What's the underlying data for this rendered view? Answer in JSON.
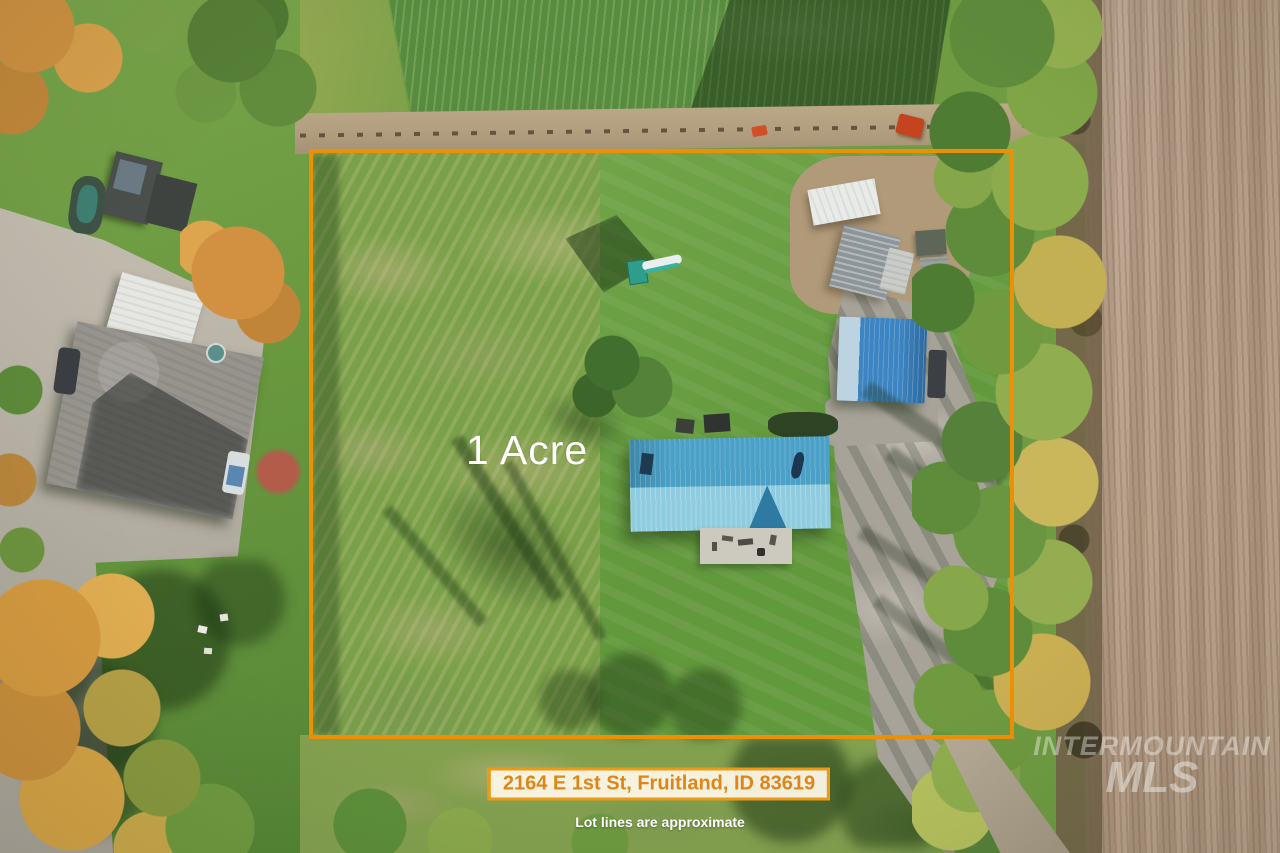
{
  "overlays": {
    "lot_label": "1 Acre",
    "address": "2164 E 1st St, Fruitland, ID 83619",
    "disclaimer": "Lot lines are approximate",
    "watermark_line1": "INTERMOUNTAIN",
    "watermark_line2": "MLS"
  },
  "colors": {
    "boundary_orange": "#EE9005",
    "banner_border": "#EC9A15",
    "banner_text": "#DE861A",
    "banner_bg": "rgba(252,247,230,0.95)"
  }
}
